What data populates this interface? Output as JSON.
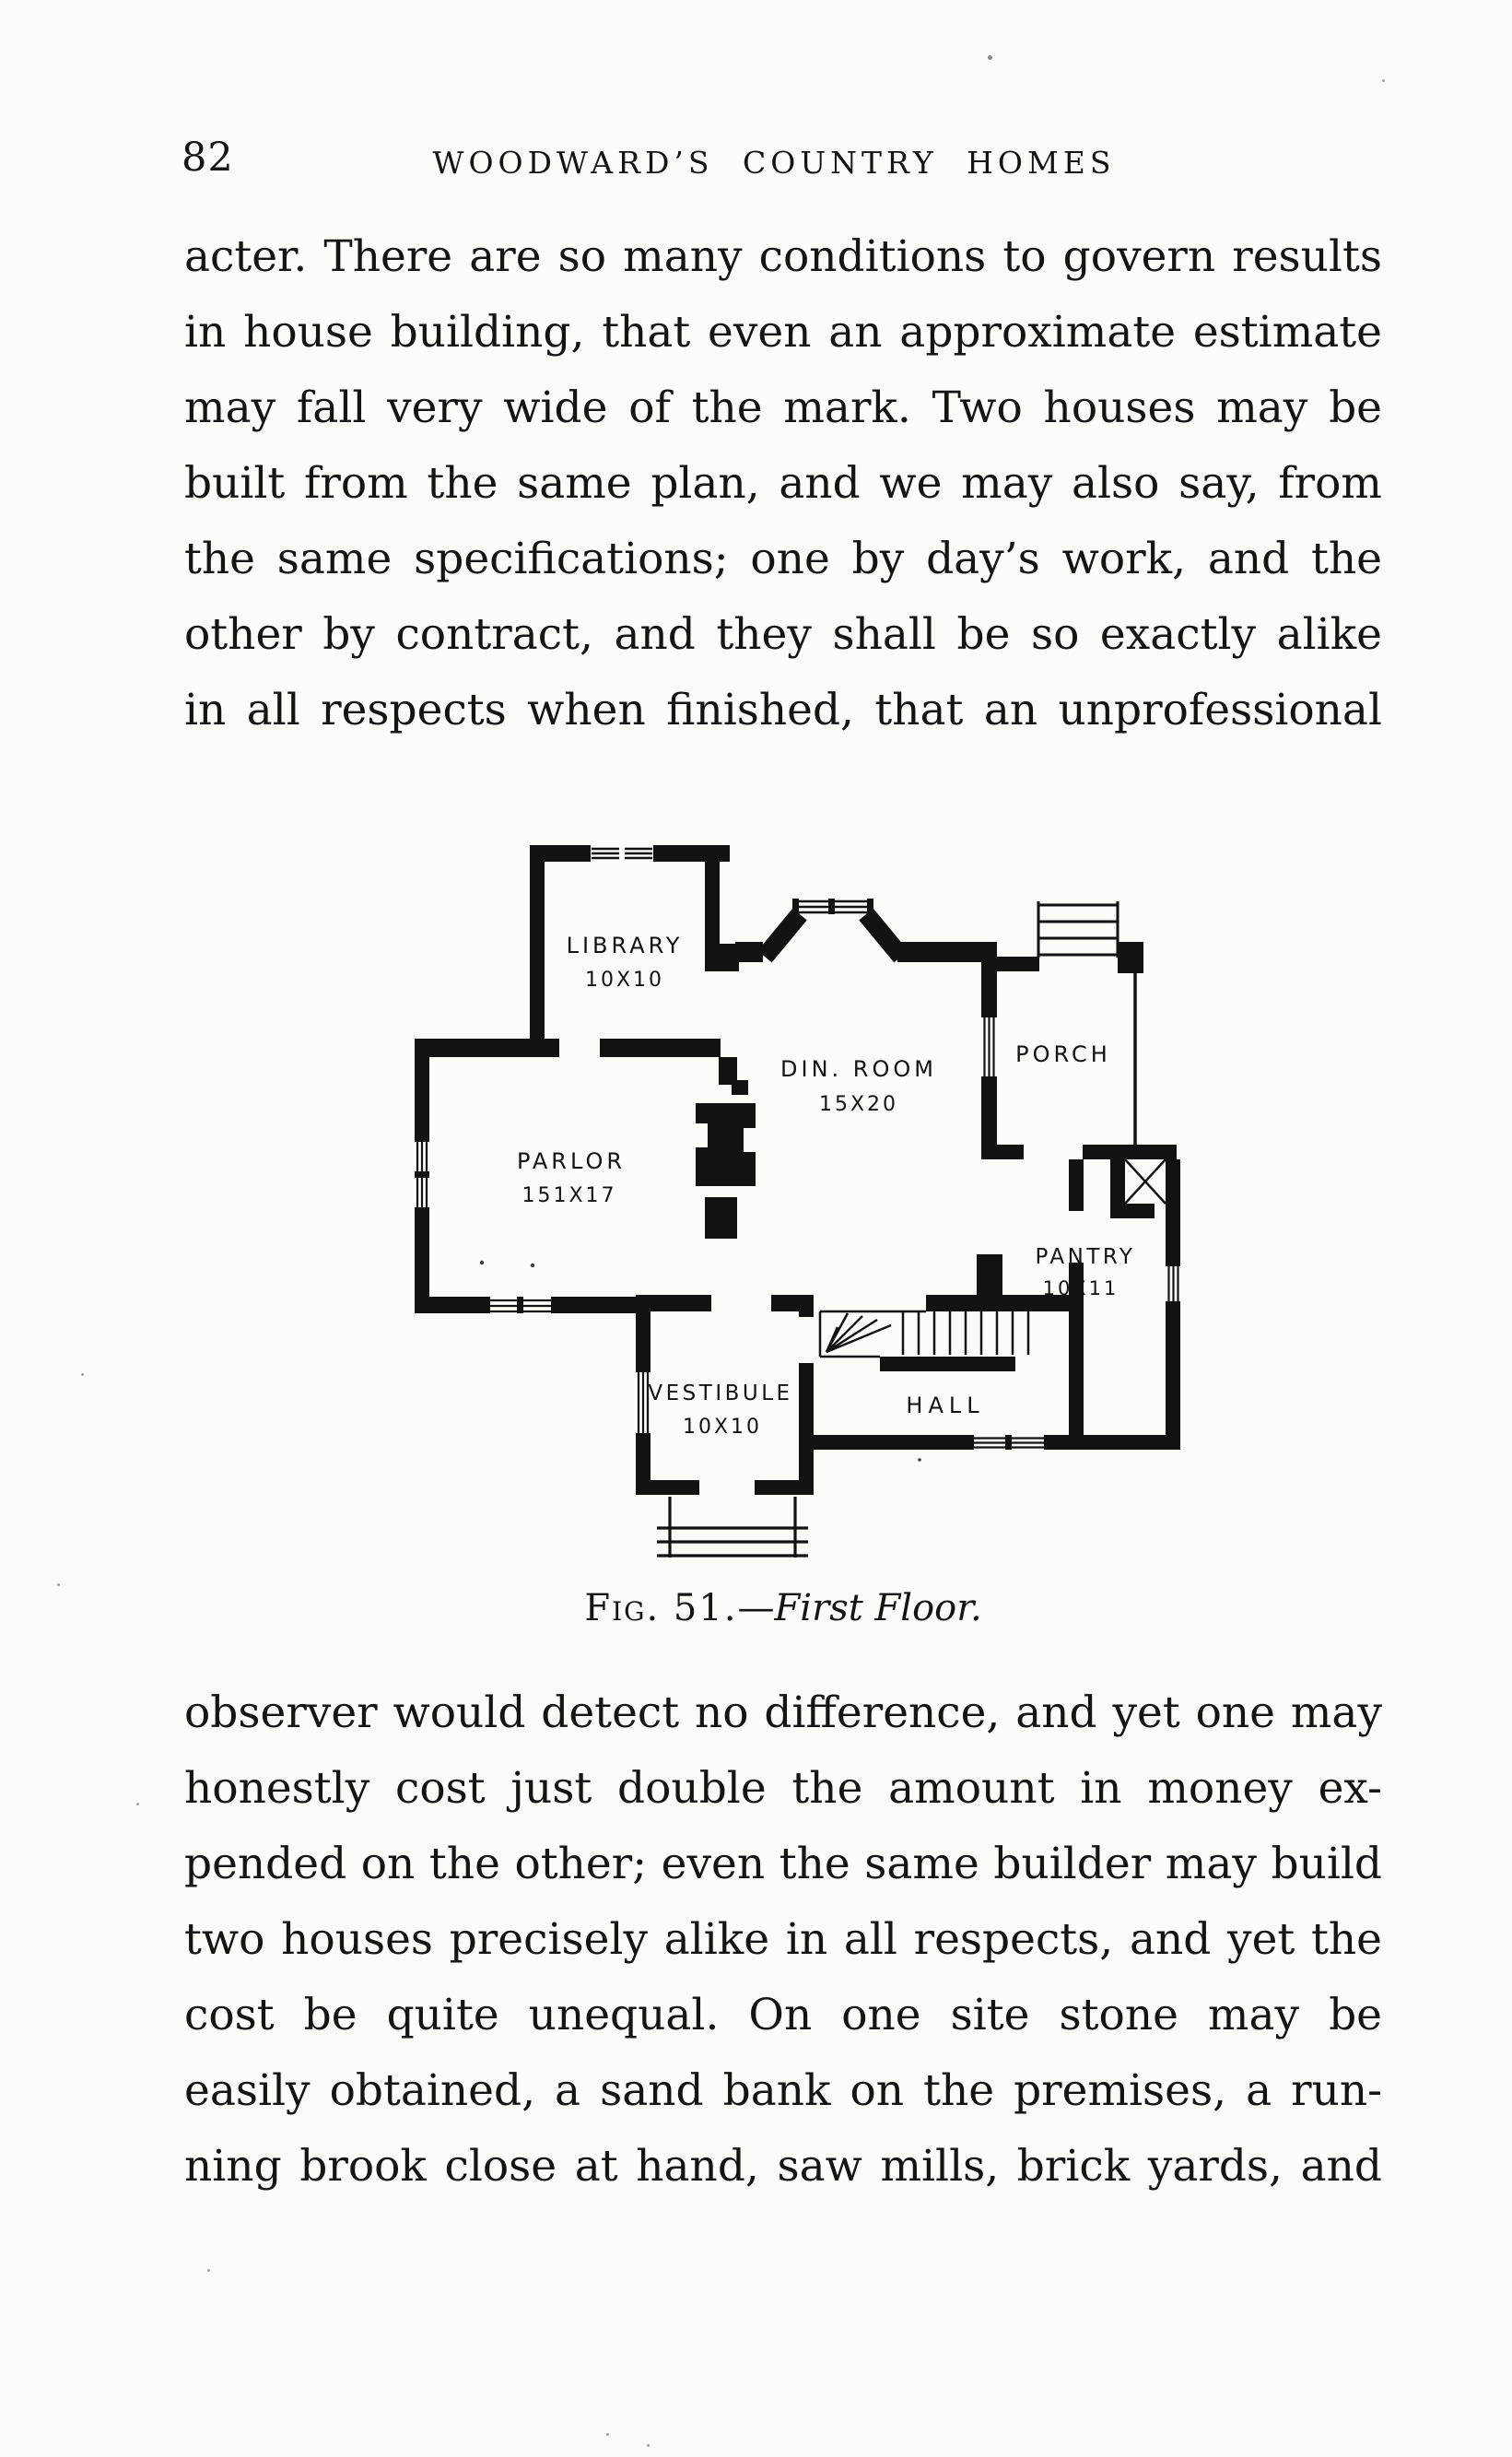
{
  "page": {
    "number": "82",
    "running_head": "WOODWARD’S COUNTRY HOMES"
  },
  "paragraph_1": {
    "lines": [
      "acter. There are so many conditions to govern results",
      "in house building, that even an approximate estimate",
      "may fall very wide of the mark. Two houses may be",
      "built from the same plan, and we may also say, from",
      "the same specifications; one by day’s work, and the",
      "other by contract, and they shall be so exactly alike",
      "in all respects when finished, that an unprofessional"
    ]
  },
  "figure": {
    "caption": {
      "label": "Fig. 51.",
      "dash": "—",
      "title": "First Floor."
    },
    "rooms": [
      {
        "id": "library",
        "name": "LIBRARY",
        "dims": "10X10"
      },
      {
        "id": "dining",
        "name": "DIN. ROOM",
        "dims": "15X20"
      },
      {
        "id": "porch",
        "name": "PORCH",
        "dims": ""
      },
      {
        "id": "parlor",
        "name": "PARLOR",
        "dims": "151X17"
      },
      {
        "id": "pantry",
        "name": "PANTRY",
        "dims": "10X11"
      },
      {
        "id": "vestibule",
        "name": "VESTIBULE",
        "dims": "10X10"
      },
      {
        "id": "hall",
        "name": "HALL",
        "dims": ""
      }
    ]
  },
  "paragraph_2": {
    "lines": [
      "observer would detect no difference, and yet one may",
      "honestly cost just double the amount in money ex-",
      "pended on the other; even the same builder may build",
      "two houses precisely alike in all respects, and yet the",
      "cost be quite unequal. On one site stone may be",
      "easily obtained, a sand bank on the premises, a run-",
      "ning brook close at hand, saw mills, brick yards, and"
    ]
  }
}
